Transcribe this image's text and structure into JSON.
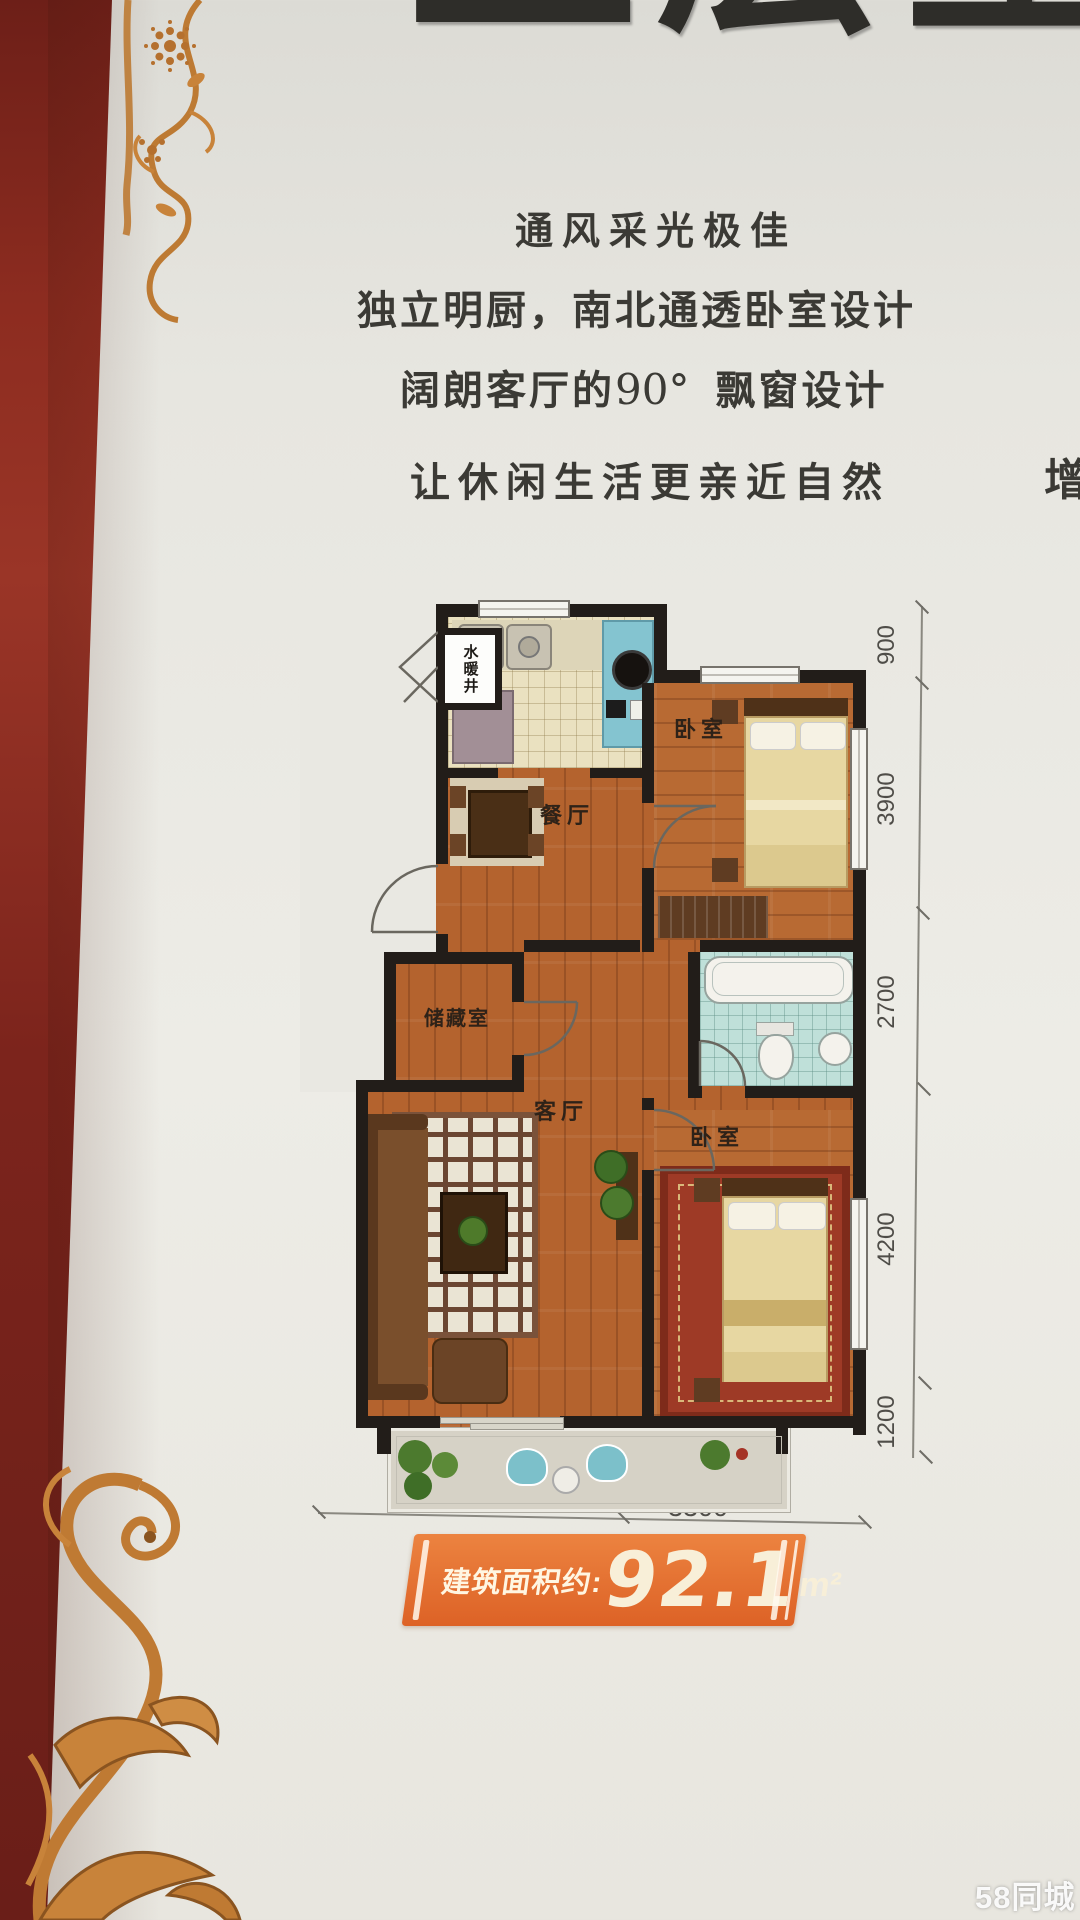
{
  "header": {
    "title": "上层生活"
  },
  "features": {
    "line1": "通风采光极佳",
    "line2": "独立明厨，南北通透卧室设计",
    "line3_prefix": "阔朗客厅的",
    "line3_angle": "90°",
    "line3_suffix": "飘窗设计",
    "line4": "让休闲生活更亲近自然",
    "edge_partial": "增"
  },
  "floorplan": {
    "labels": {
      "shaft": "水暖井",
      "bedroom_top": "卧室",
      "dining": "餐厅",
      "storage": "储藏室",
      "living": "客厅",
      "bedroom_bottom": "卧室"
    },
    "dims_right": [
      "900",
      "3900",
      "2700",
      "4200",
      "1200"
    ],
    "dims_bottom": [
      "3900",
      "3300"
    ]
  },
  "area_banner": {
    "label": "建筑面积约:",
    "value": "92.1",
    "unit": "m²"
  },
  "watermark": "58同城",
  "colors": {
    "accent_orange": "#e06a2e",
    "wall_black": "#221d19",
    "wood_floor": "#b4632e",
    "maroon_edge": "#7c251f",
    "ornament_gold": "#bf7a33"
  }
}
